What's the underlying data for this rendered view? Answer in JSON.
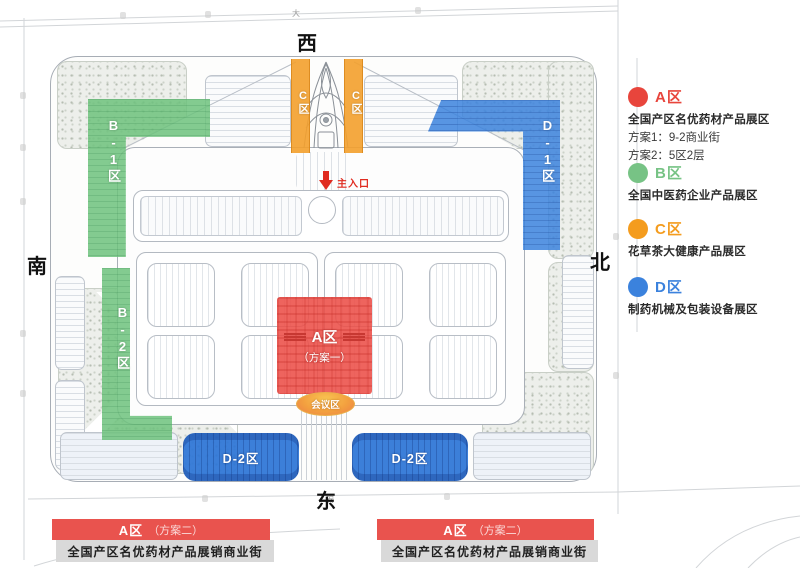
{
  "colors": {
    "zone_a_red": "#e8453c",
    "zone_b_green": "#77c385",
    "zone_c_orange": "#f49c1e",
    "zone_d_blue": "#3b82dd",
    "conference_orange": "#f3a03f",
    "banner_red": "#e9534e"
  },
  "compass": {
    "west": "西",
    "south": "南",
    "north": "北",
    "east": "东"
  },
  "plan": {
    "entrance": "主入口",
    "zone_b1": "B-1区",
    "zone_b2": "B-2区",
    "zone_c_left": "C区",
    "zone_c_right": "C区",
    "zone_d1": "D-1区",
    "zone_d2_left": "D-2区",
    "zone_d2_right": "D-2区",
    "zone_a_label": "A区",
    "zone_a_sub": "（方案一）",
    "conference": "会议区",
    "road_char_top": "大",
    "road_char_bottom": "安"
  },
  "legend": {
    "items": [
      {
        "label": "A区",
        "color": "#e8453c",
        "desc": "全国产区名优药材产品展区",
        "line1": "方案1：9-2商业街",
        "line2": "方案2：5区2层"
      },
      {
        "label": "B区",
        "color": "#77c385",
        "desc": "全国中医药企业产品展区"
      },
      {
        "label": "C区",
        "color": "#f49c1e",
        "desc": "花草茶大健康产品展区"
      },
      {
        "label": "D区",
        "color": "#3b82dd",
        "desc": "制药机械及包装设备展区"
      }
    ]
  },
  "banners": {
    "left": {
      "title": "A区",
      "subtitle": "（方案二）",
      "desc": "全国产区名优药材产品展销商业街"
    },
    "right": {
      "title": "A区",
      "subtitle": "（方案二）",
      "desc": "全国产区名优药材产品展销商业街"
    }
  }
}
